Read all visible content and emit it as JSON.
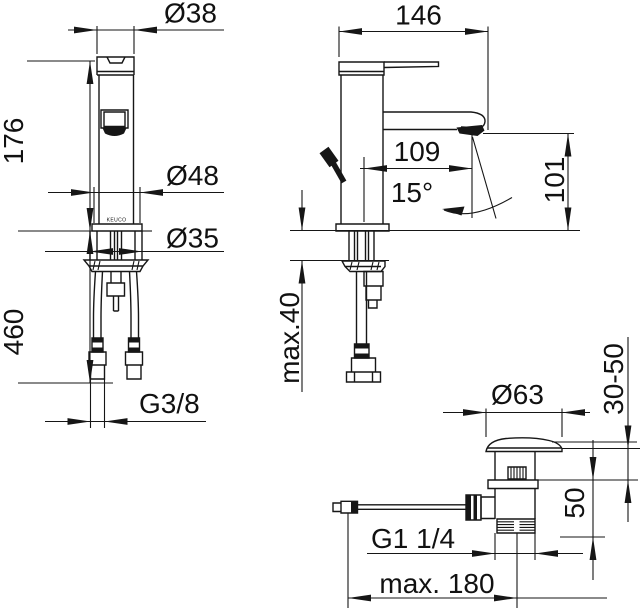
{
  "drawing": {
    "kind": "faucet-technical-dimension-drawing",
    "brand": "KEUCO",
    "colors": {
      "line": "#161616",
      "background": "#ffffff"
    },
    "front": {
      "spout_diameter": "Ø38",
      "height_to_top": "176",
      "base_diameter": "Ø48",
      "hole_diameter": "Ø35",
      "hose_length": "460",
      "supply_thread": "G3/8"
    },
    "side": {
      "overall_depth": "146",
      "spout_reach": "109",
      "stream_angle": "15°",
      "outlet_height": "101",
      "deck_thickness_max": "max.40"
    },
    "drain": {
      "cap_diameter": "Ø63",
      "adjust_range": "30-50",
      "body_height": "50",
      "waste_thread": "G1 1/4",
      "rod_length_max": "max. 180"
    }
  }
}
